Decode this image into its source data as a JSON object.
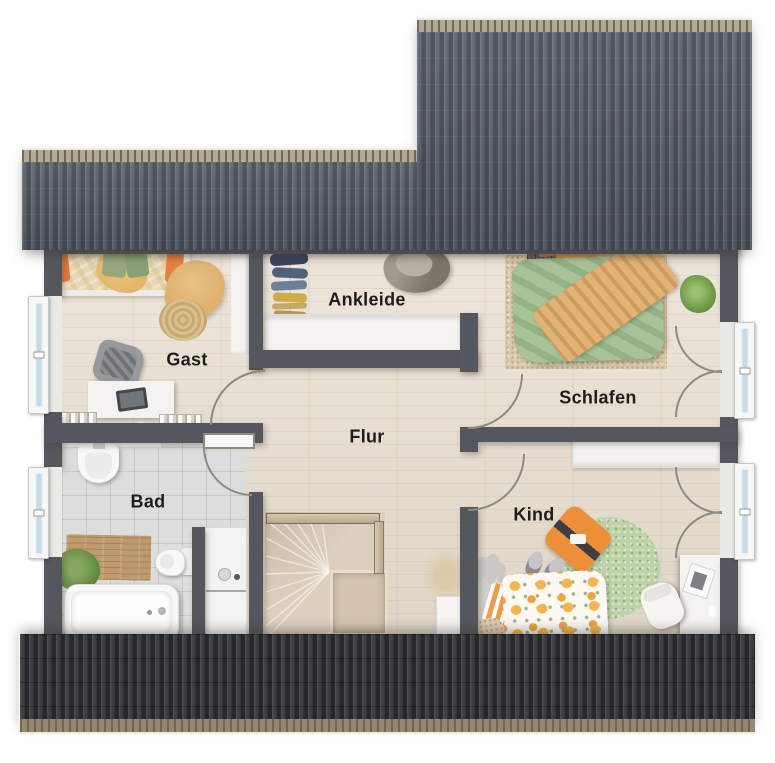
{
  "rooms": {
    "gast": {
      "label": "Gast"
    },
    "ankleide": {
      "label": "Ankleide"
    },
    "schlafen": {
      "label": "Schlafen"
    },
    "flur": {
      "label": "Flur"
    },
    "bad": {
      "label": "Bad"
    },
    "kind": {
      "label": "Kind"
    }
  },
  "colors": {
    "roof_top": "#59616d",
    "roof_ridge": "#b4a992",
    "roof_bottom": "#3b3e44",
    "gutter": "#97876f",
    "wall": "#54575d",
    "wood_floor": "#e8decf",
    "tile_floor": "#dcdedd",
    "stair_wood": "#dccfbe",
    "label_text": "#1d1d1d",
    "accent_orange": "#ec8f38",
    "accent_green": "#a9c398",
    "accent_tan": "#e2b376",
    "furniture_white": "#f4f3f1",
    "window_glass": "#c3dbe8"
  }
}
